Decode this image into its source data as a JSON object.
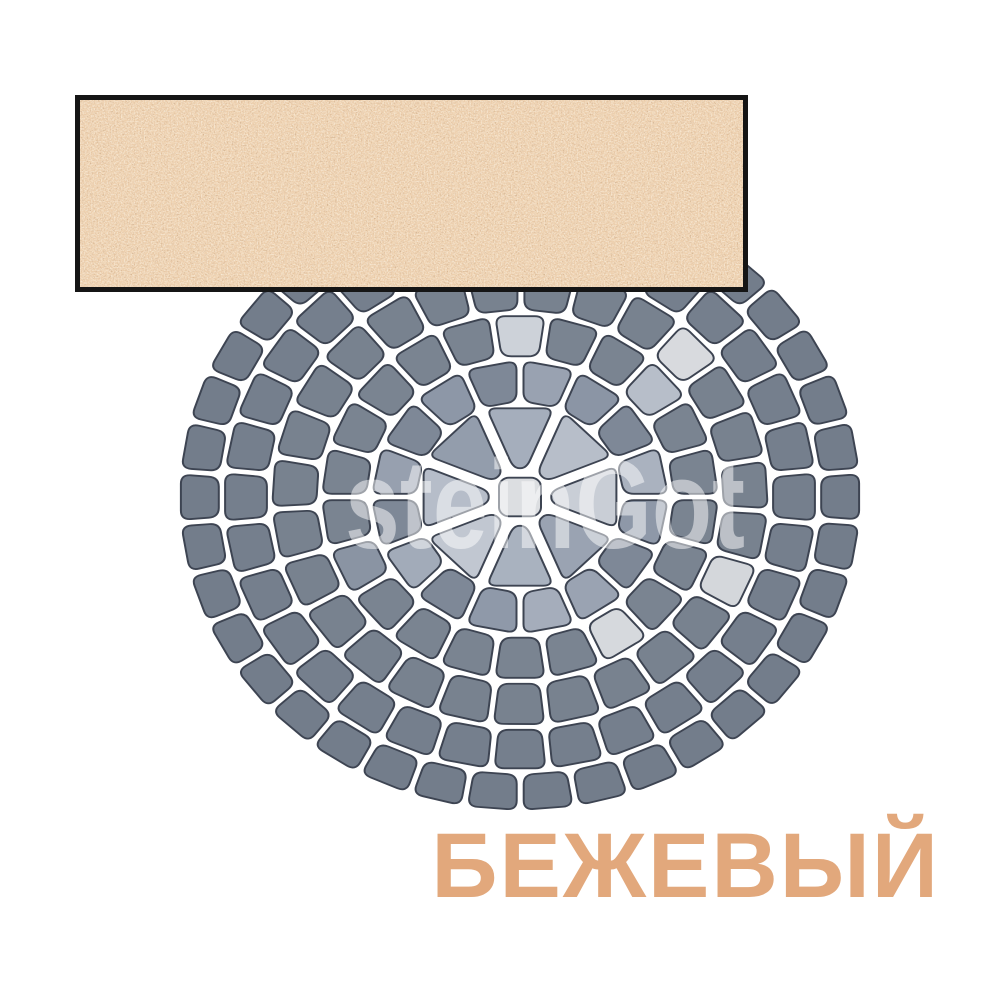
{
  "product": {
    "color_name": "БЕЖЕВЫЙ",
    "watermark": "steinGot"
  },
  "colors": {
    "background": "#ffffff",
    "label_text": "#e2a87c",
    "swatch_border": "#151515",
    "swatch_base": "#eed0ad",
    "stone_outline": "#3d4452",
    "center_stone_fill": "#dcdee1",
    "watermark_fill": "#ffffff"
  },
  "swatch": {
    "x": 75,
    "y": 95,
    "width": 673,
    "height": 197,
    "border": 5
  },
  "label_layout": {
    "x": 940,
    "y": 897,
    "font_size": 92
  },
  "watermark_layout": {
    "x": 545,
    "y": 548,
    "font_size": 126,
    "text_length": 400,
    "opacity": 0.5
  },
  "paving": {
    "cx": 520,
    "cy": 497,
    "squash": 0.92,
    "gap": 7,
    "corner": 10,
    "center_size": 42,
    "rings": [
      {
        "count": 8,
        "rIn": 32,
        "rOut": 102,
        "gap": 12,
        "offsetDeg": 0,
        "default": "#a8b1be",
        "overrides": {
          "0": "#a5aebc",
          "1": "#b7bec9",
          "2": "#c9ced6",
          "3": "#9aa3b2",
          "4": "#a9b2bf",
          "5": "#c1c7d1",
          "6": "#b6bdc9",
          "7": "#939dac"
        }
      },
      {
        "count": 16,
        "rIn": 104,
        "rOut": 148,
        "offsetDeg": 11.25,
        "default": "#7e8897",
        "overrides": {
          "0": "#99a2b1",
          "1": "#8b95a5",
          "3": "#aab2bf",
          "4": "#8e98a8",
          "6": "#9aa3b2",
          "7": "#a5adbb",
          "8": "#8f99a9",
          "10": "#a2abb9",
          "12": "#97a0af",
          "14": "#8d97a7"
        }
      },
      {
        "count": 22,
        "rIn": 154,
        "rOut": 198,
        "offsetDeg": 0,
        "default": "#7a8491",
        "overrides": {
          "0": "#cdd2d9",
          "3": "#b7bec9",
          "9": "#d6d9dd",
          "15": "#8a94a3"
        }
      },
      {
        "count": 27,
        "rIn": 204,
        "rOut": 248,
        "offsetDeg": 6.9,
        "default": "#78828f",
        "overrides": {
          "3": "#d8dade",
          "8": "#d4d7db"
        }
      },
      {
        "count": 32,
        "rIn": 254,
        "rOut": 296,
        "offsetDeg": 0,
        "default": "#757f8d",
        "overrides": {}
      },
      {
        "count": 38,
        "rIn": 302,
        "rOut": 340,
        "offsetDeg": 4.7,
        "default": "#737d8b",
        "overrides": {}
      }
    ]
  }
}
